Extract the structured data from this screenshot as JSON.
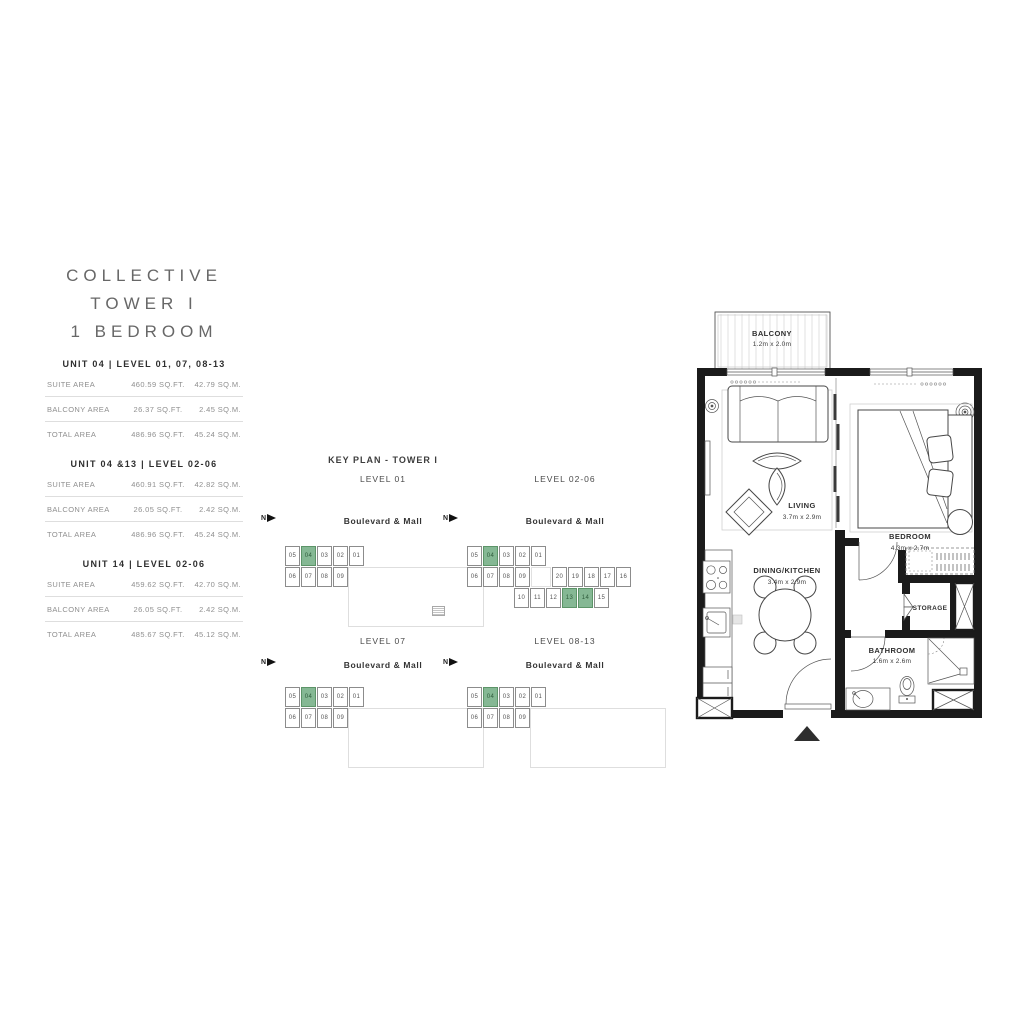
{
  "brand": {
    "line1": "COLLECTIVE",
    "line2": "TOWER I",
    "line3": "1 BEDROOM"
  },
  "unit_tables": [
    {
      "header": "UNIT 04 | LEVEL 01, 07, 08-13",
      "rows": [
        {
          "label": "SUITE AREA",
          "sqft": "460.59 SQ.FT.",
          "sqm": "42.79 SQ.M."
        },
        {
          "label": "BALCONY AREA",
          "sqft": "26.37 SQ.FT.",
          "sqm": "2.45 SQ.M."
        },
        {
          "label": "TOTAL AREA",
          "sqft": "486.96 SQ.FT.",
          "sqm": "45.24 SQ.M."
        }
      ]
    },
    {
      "header": "UNIT 04 &13 | LEVEL 02-06",
      "rows": [
        {
          "label": "SUITE AREA",
          "sqft": "460.91 SQ.FT.",
          "sqm": "42.82 SQ.M."
        },
        {
          "label": "BALCONY AREA",
          "sqft": "26.05 SQ.FT.",
          "sqm": "2.42 SQ.M."
        },
        {
          "label": "TOTAL AREA",
          "sqft": "486.96 SQ.FT.",
          "sqm": "45.24 SQ.M."
        }
      ]
    },
    {
      "header": "UNIT 14 | LEVEL 02-06",
      "rows": [
        {
          "label": "SUITE AREA",
          "sqft": "459.62 SQ.FT.",
          "sqm": "42.70 SQ.M."
        },
        {
          "label": "BALCONY AREA",
          "sqft": "26.05 SQ.FT.",
          "sqm": "2.42 SQ.M."
        },
        {
          "label": "TOTAL AREA",
          "sqft": "485.67 SQ.FT.",
          "sqm": "45.12 SQ.M."
        }
      ]
    }
  ],
  "key_plan": {
    "title": "KEY PLAN - TOWER I",
    "north_label": "N",
    "highlight_color": "#85b894",
    "plans": [
      {
        "level": "LEVEL 01",
        "street": "Boulevard & Mall",
        "podium": true,
        "stair": true,
        "rows": [
          [
            "05",
            "04*",
            "03",
            "02",
            "01"
          ],
          [
            "06",
            "07",
            "08",
            "09"
          ]
        ]
      },
      {
        "level": "LEVEL 02-06",
        "street": "Boulevard & Mall",
        "podium": false,
        "stair": false,
        "rows": [
          [
            "05",
            "04*",
            "03",
            "02",
            "01"
          ],
          [
            "06",
            "07",
            "08",
            "09",
            "|",
            "20",
            "19",
            "18",
            "17",
            "16"
          ],
          [
            ">",
            "10",
            "11",
            "12",
            "13*",
            "14*",
            "15"
          ]
        ]
      },
      {
        "level": "LEVEL 07",
        "street": "Boulevard & Mall",
        "podium": true,
        "stair": false,
        "rows": [
          [
            "05",
            "04*",
            "03",
            "02",
            "01"
          ],
          [
            "06",
            "07",
            "08",
            "09"
          ]
        ]
      },
      {
        "level": "LEVEL 08-13",
        "street": "Boulevard & Mall",
        "podium": true,
        "stair": false,
        "rows": [
          [
            "05",
            "04*",
            "03",
            "02",
            "01"
          ],
          [
            "06",
            "07",
            "08",
            "09"
          ]
        ]
      }
    ]
  },
  "floor_plan": {
    "balcony": {
      "name": "BALCONY",
      "dims": "1.2m x 2.0m"
    },
    "living": {
      "name": "LIVING",
      "dims": "3.7m x 2.9m"
    },
    "bedroom": {
      "name": "BEDROOM",
      "dims": "4.3m x 2.7m"
    },
    "dining_kitchen": {
      "name": "DINING/KITCHEN",
      "dims": "3.4m x 2.9m"
    },
    "storage": {
      "name": "STORAGE"
    },
    "bathroom": {
      "name": "BATHROOM",
      "dims": "1.6m x 2.6m"
    }
  },
  "colors": {
    "highlight": "#85b894",
    "wall": "#1b1b1b",
    "line": "#4a4a4a",
    "text_muted": "#8f8f8f"
  }
}
